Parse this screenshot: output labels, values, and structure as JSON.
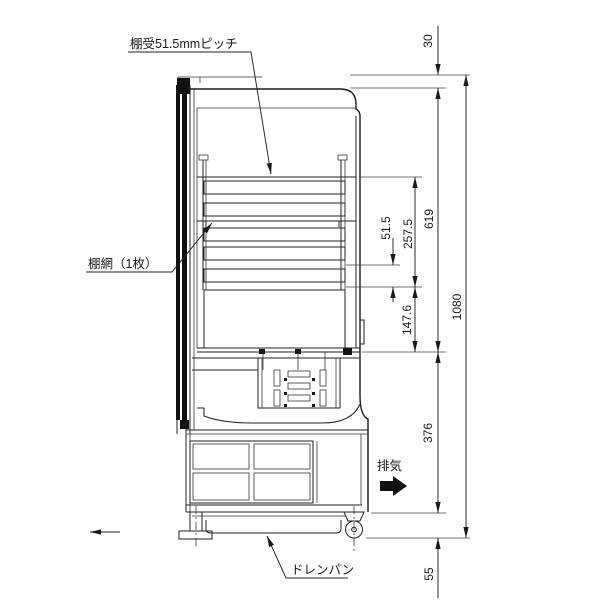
{
  "labels": {
    "shelf_pitch": "棚受51.5mmピッチ",
    "shelf_net": "棚網（1枚）",
    "exhaust": "排気",
    "drain_pan": "ドレンパン"
  },
  "dimensions": {
    "top_offset": "30",
    "shelf_zone_height": "619",
    "shelf_pitch": "51.5",
    "pitch_span": "257.5",
    "lower_zone": "147.6",
    "overall_height": "1080",
    "machine_zone_height": "376",
    "base_height": "55"
  }
}
